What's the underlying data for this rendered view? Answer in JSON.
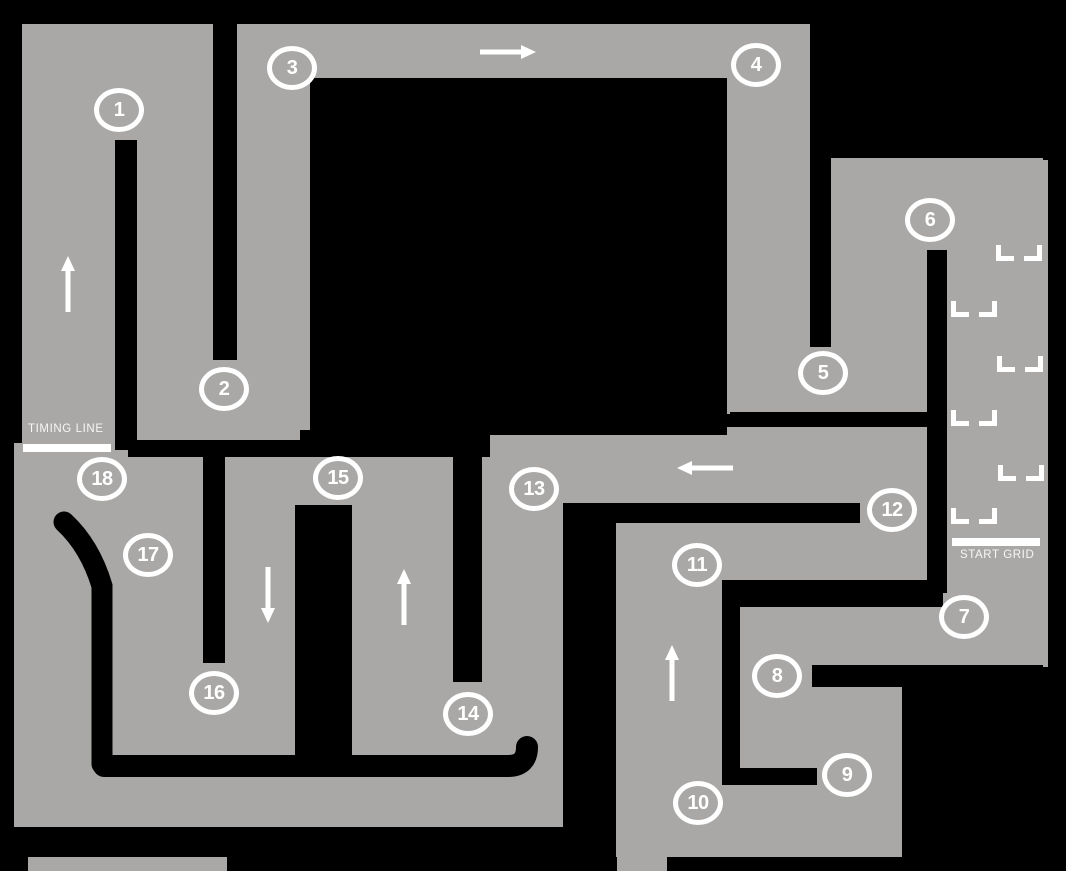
{
  "map": {
    "title": "Kart circuit track map",
    "colors": {
      "track_surface": "#a9a8a6",
      "background": "#000000",
      "markings": "#ffffff"
    },
    "timing_line": {
      "label": "TIMING LINE"
    },
    "start_grid": {
      "label": "START GRID",
      "slot_count": 6
    },
    "corners": [
      {
        "number": "1",
        "x": 119,
        "y": 110
      },
      {
        "number": "2",
        "x": 224,
        "y": 389
      },
      {
        "number": "3",
        "x": 292,
        "y": 68
      },
      {
        "number": "4",
        "x": 756,
        "y": 65
      },
      {
        "number": "5",
        "x": 823,
        "y": 373
      },
      {
        "number": "6",
        "x": 930,
        "y": 220
      },
      {
        "number": "7",
        "x": 964,
        "y": 617
      },
      {
        "number": "8",
        "x": 777,
        "y": 676
      },
      {
        "number": "9",
        "x": 847,
        "y": 775
      },
      {
        "number": "10",
        "x": 698,
        "y": 803
      },
      {
        "number": "11",
        "x": 697,
        "y": 565
      },
      {
        "number": "12",
        "x": 892,
        "y": 510
      },
      {
        "number": "13",
        "x": 534,
        "y": 489
      },
      {
        "number": "14",
        "x": 468,
        "y": 714
      },
      {
        "number": "15",
        "x": 338,
        "y": 478
      },
      {
        "number": "16",
        "x": 214,
        "y": 693
      },
      {
        "number": "17",
        "x": 148,
        "y": 555
      },
      {
        "number": "18",
        "x": 102,
        "y": 479
      }
    ],
    "direction_arrows": [
      {
        "id": "timing-straight",
        "direction": "up",
        "x": 60,
        "y": 255
      },
      {
        "id": "top-straight",
        "direction": "right",
        "x": 479,
        "y": 44
      },
      {
        "id": "back-straight",
        "direction": "left",
        "x": 676,
        "y": 460
      },
      {
        "id": "lane-15-16",
        "direction": "down",
        "x": 260,
        "y": 566
      },
      {
        "id": "lane-14-15",
        "direction": "up",
        "x": 396,
        "y": 568
      },
      {
        "id": "lane-10-11",
        "direction": "up",
        "x": 664,
        "y": 644
      }
    ],
    "grid_slots": [
      {
        "x": 996,
        "y": 245
      },
      {
        "x": 951,
        "y": 301
      },
      {
        "x": 997,
        "y": 356
      },
      {
        "x": 951,
        "y": 410
      },
      {
        "x": 998,
        "y": 465
      },
      {
        "x": 951,
        "y": 508
      }
    ]
  }
}
